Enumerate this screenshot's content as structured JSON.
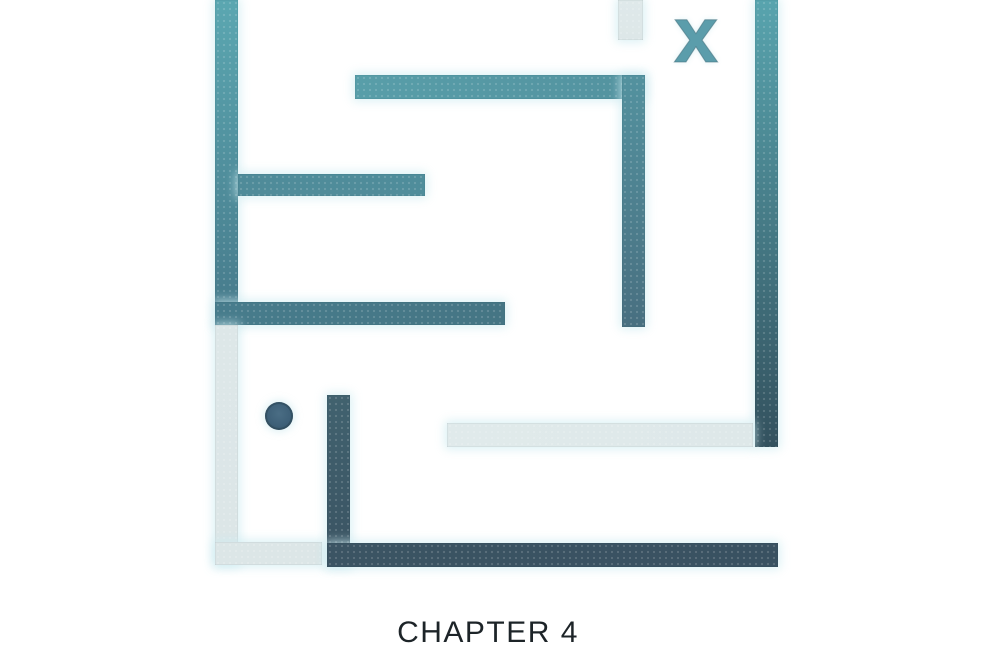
{
  "chapter": {
    "label": "CHAPTER 4",
    "text_color": "#1d2428",
    "center_x": 488,
    "top": 616
  },
  "goal_marker": {
    "glyph": "x",
    "color": "#5b9dab",
    "center_x": 696,
    "center_y": 40
  },
  "player_dot": {
    "center_x": 279,
    "center_y": 416,
    "diameter": 28,
    "color": "#3e6078"
  },
  "colors": {
    "background": "#ffffff",
    "teal_light": "#5ba7b1",
    "teal_mid": "#4f8d9b",
    "slate_dark": "#3a5363",
    "gray_wall": "#dde7e8",
    "glow": "#d2ecf0"
  },
  "maze": {
    "walls": [
      {
        "name": "wall-left-vertical",
        "x": 215,
        "y": 0,
        "w": 23,
        "h": 325,
        "dir": "to bottom",
        "c1": "#5ba7b1",
        "c2": "#46798a"
      },
      {
        "name": "wall-top-horizontal",
        "x": 355,
        "y": 75,
        "w": 290,
        "h": 24,
        "dir": "to right",
        "c1": "#589ea9",
        "c2": "#53929f"
      },
      {
        "name": "wall-mid-vertical",
        "x": 622,
        "y": 75,
        "w": 23,
        "h": 252,
        "dir": "to bottom",
        "c1": "#53929f",
        "c2": "#486f80"
      },
      {
        "name": "wall-mid-left-horizontal",
        "x": 238,
        "y": 174,
        "w": 187,
        "h": 22,
        "dir": "to right",
        "c1": "#4f8b99",
        "c2": "#4f8d9b"
      },
      {
        "name": "wall-lower-left-horizontal",
        "x": 215,
        "y": 302,
        "w": 290,
        "h": 23,
        "dir": "to right",
        "c1": "#477c8c",
        "c2": "#457584"
      },
      {
        "name": "wall-right-vertical",
        "x": 755,
        "y": 0,
        "w": 23,
        "h": 447,
        "dir": "to bottom",
        "c1": "#58a4ae",
        "c2": "#33515e"
      },
      {
        "name": "wall-gray-top-stub",
        "x": 618,
        "y": 0,
        "w": 25,
        "h": 40,
        "dir": "to bottom",
        "c1": "#dfe9ea",
        "c2": "#dde7e8"
      },
      {
        "name": "wall-gray-left-vertical",
        "x": 215,
        "y": 325,
        "w": 23,
        "h": 240,
        "dir": "to bottom",
        "c1": "#dde7e8",
        "c2": "#dce6e7"
      },
      {
        "name": "wall-gray-left-foot",
        "x": 215,
        "y": 542,
        "w": 107,
        "h": 23,
        "dir": "to right",
        "c1": "#dce6e7",
        "c2": "#dce6e7"
      },
      {
        "name": "wall-gray-mid-horizontal",
        "x": 447,
        "y": 423,
        "w": 306,
        "h": 24,
        "dir": "to right",
        "c1": "#e0eaeb",
        "c2": "#dee8e9"
      },
      {
        "name": "wall-dark-vertical",
        "x": 327,
        "y": 395,
        "w": 23,
        "h": 172,
        "dir": "to bottom",
        "c1": "#41626f",
        "c2": "#3a5362"
      },
      {
        "name": "wall-bottom-horizontal",
        "x": 327,
        "y": 543,
        "w": 451,
        "h": 24,
        "dir": "to right",
        "c1": "#3b5463",
        "c2": "#395161"
      }
    ]
  }
}
